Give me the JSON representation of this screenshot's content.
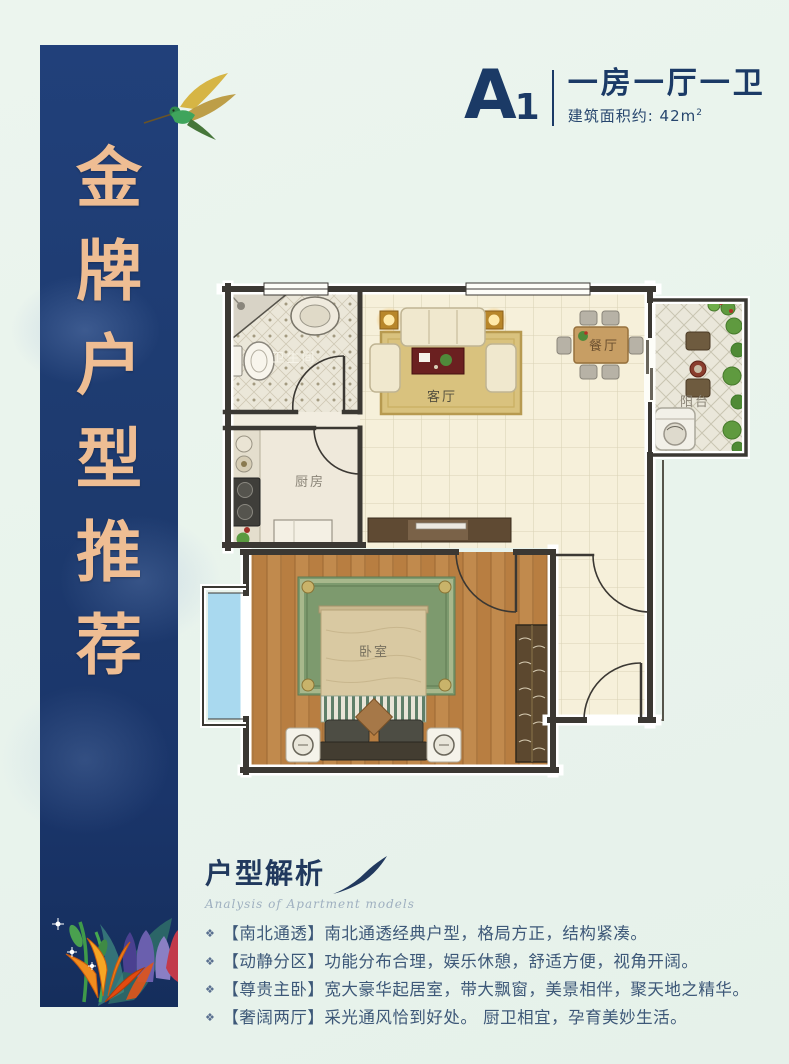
{
  "banner": {
    "chars": [
      "金",
      "牌",
      "户",
      "型",
      "推",
      "荐"
    ]
  },
  "header": {
    "code": "A",
    "code_sub": "1",
    "title": "一房一厅一卫",
    "area": "建筑面积约: 42m",
    "area_sup": "2"
  },
  "floorplan": {
    "labels": {
      "bathroom": "卫生间",
      "kitchen": "厨房",
      "living": "客厅",
      "dining": "餐厅",
      "balcony": "阳台",
      "bedroom": "卧室"
    }
  },
  "analysis": {
    "title": "户型解析",
    "subtitle": "Analysis of Apartment models",
    "bullets": [
      {
        "marker": "❖",
        "text": "【南北通透】南北通透经典户型，格局方正，结构紧凑。"
      },
      {
        "marker": "❖",
        "text": "【动静分区】功能分布合理，娱乐休憩，舒适方便，视角开阔。"
      },
      {
        "marker": "❖",
        "text": "【尊贵主卧】宽大豪华起居室，带大飘窗，美景相伴，聚天地之精华。"
      },
      {
        "marker": "❖",
        "text": "【奢阔两厅】采光通风恰到好处。 厨卫相宜，孕育美妙生活。"
      }
    ]
  },
  "colors": {
    "banner_navy": "#1d3a6e",
    "banner_gold": "#eebd93",
    "background_mint": "#e9f3ec",
    "text_navy": "#1b3a66",
    "wall": "#3b3833",
    "living_tile": "#f6f0da",
    "bedroom_wood": "#c18a4d",
    "bay_window_blue": "#a9d9ef"
  }
}
